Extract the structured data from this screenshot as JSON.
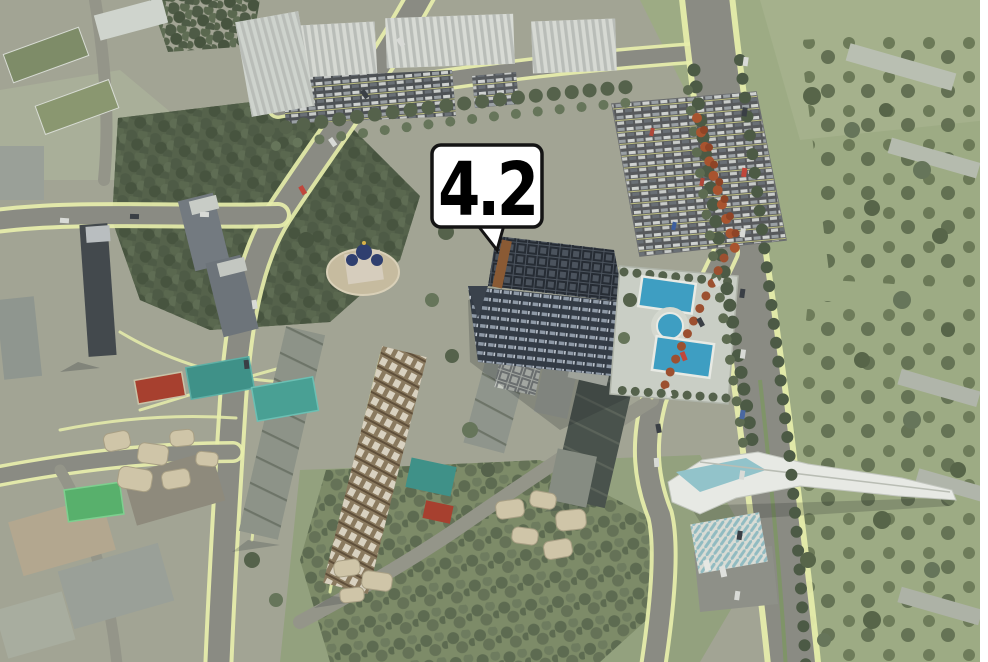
{
  "marker": {
    "label": "4.2"
  },
  "palette": {
    "terrain": "#a2a494",
    "field": "#9dab84",
    "forest": "#5f6b52",
    "road": "#8a8b83",
    "sidewalk": "#e7eeab",
    "pool": "#3e9ec2",
    "court_red": "#a7402f",
    "court_teal": "#3f9188",
    "autumn": "#a8542f",
    "callout_bg": "#ffffff",
    "callout_border": "#141414",
    "callout_text": "#111111"
  }
}
